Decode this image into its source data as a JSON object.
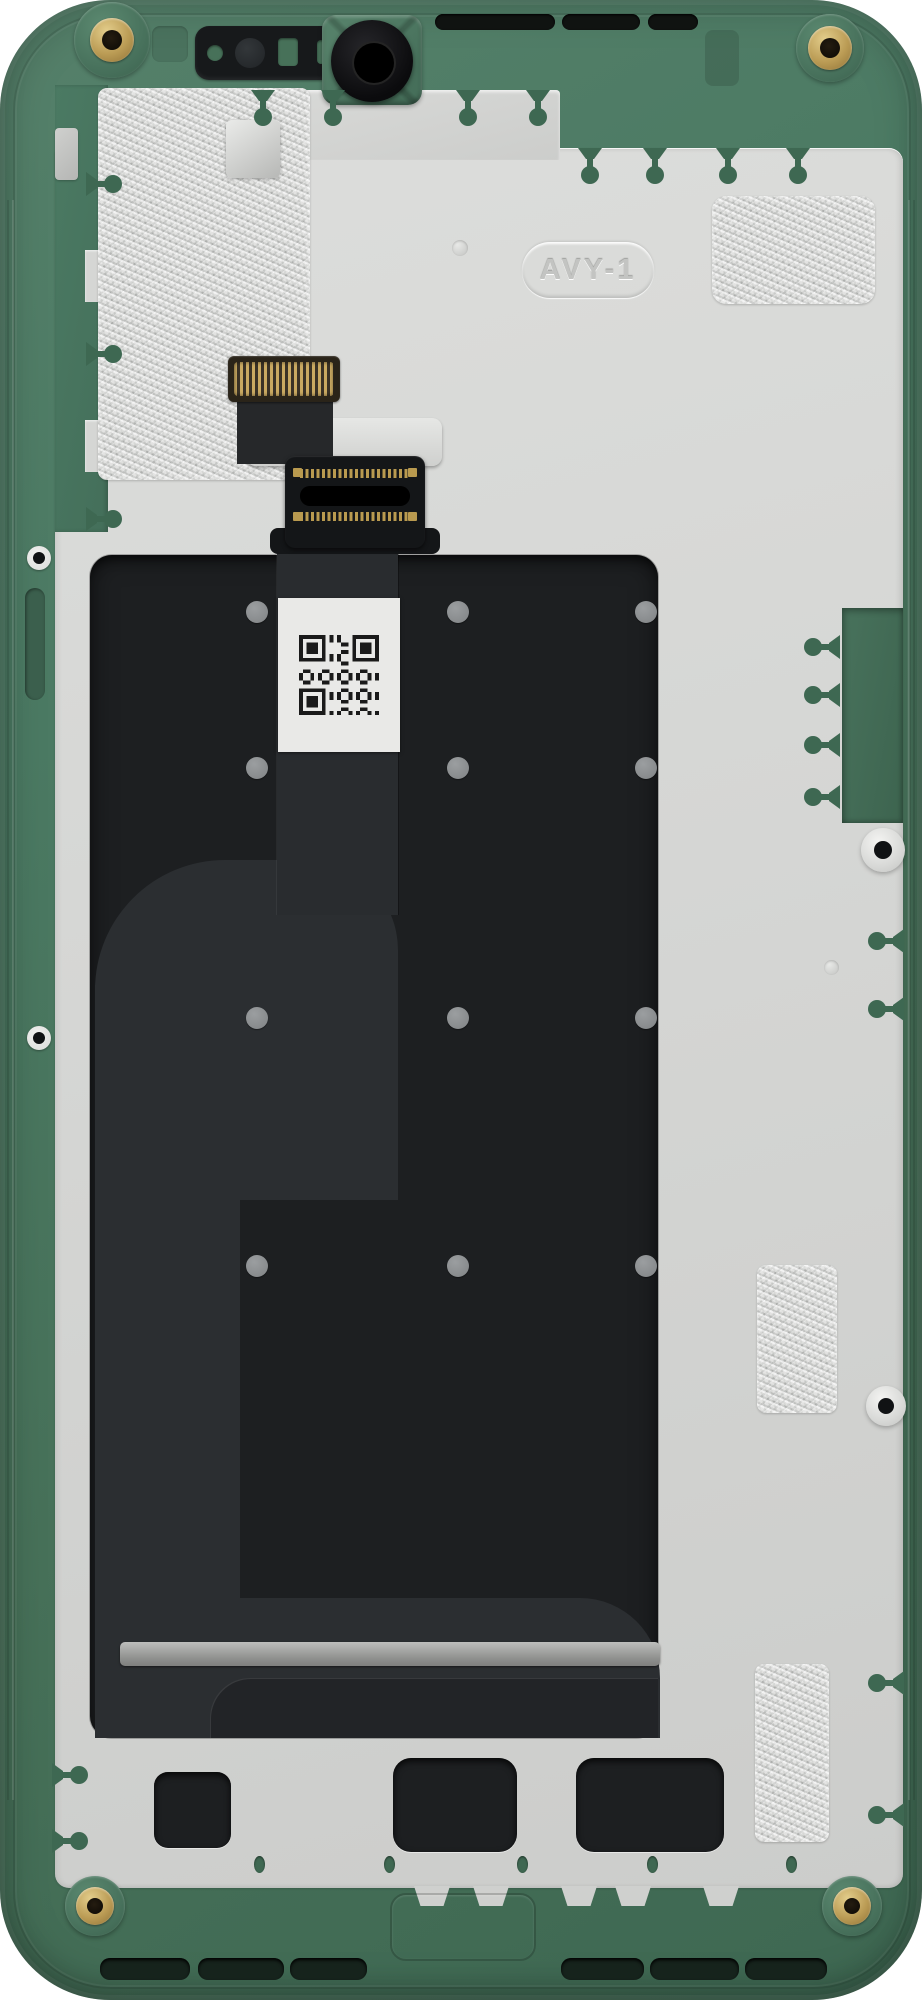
{
  "photo": {
    "subject": "smartphone-midframe-internal-rear-view",
    "marking_label": "AVY-1"
  },
  "colors": {
    "frame_green": "#4b7a63",
    "frame_green_dark": "#3e6852",
    "plate_silver": "#d5d6d4",
    "panel_black": "#1d1f21",
    "flex_gray": "#2b2e31",
    "foil_silver": "#cbccca",
    "screw_gold": "#bb9c55",
    "label_white": "#e9e9e7",
    "qr_black": "#1a1a1a"
  }
}
